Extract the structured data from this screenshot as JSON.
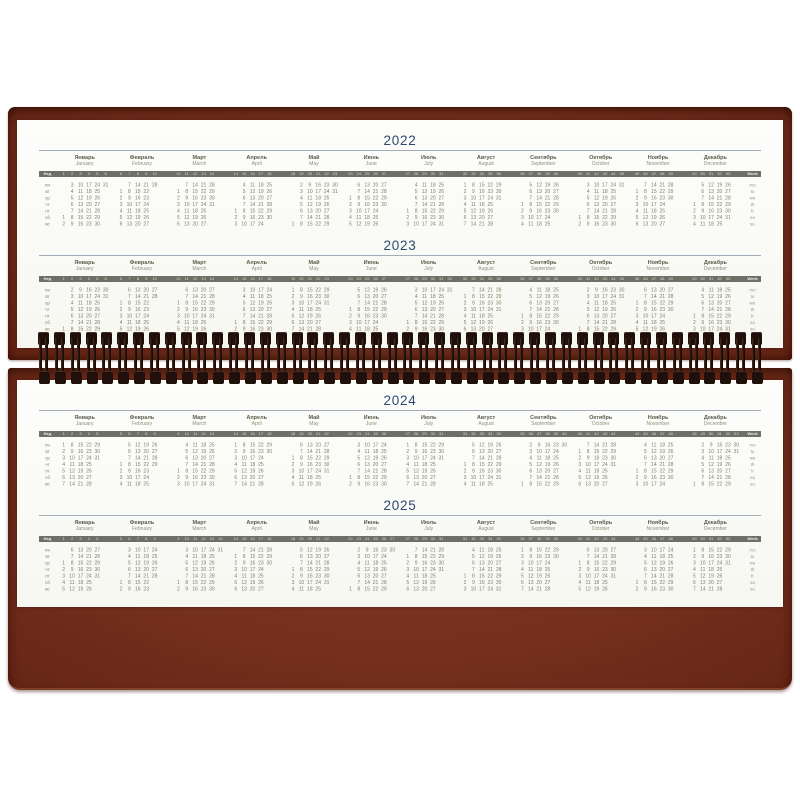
{
  "calendar": {
    "week_label_ru": "Нед",
    "week_label_en": "Week",
    "weekday_ru": [
      "пн",
      "вт",
      "ср",
      "чт",
      "пт",
      "сб",
      "вс"
    ],
    "weekday_en": [
      "mo",
      "tu",
      "we",
      "th",
      "fr",
      "sa",
      "su"
    ],
    "month_names": [
      {
        "ru": "Январь",
        "en": "January"
      },
      {
        "ru": "Февраль",
        "en": "February"
      },
      {
        "ru": "Март",
        "en": "March"
      },
      {
        "ru": "Апрель",
        "en": "April"
      },
      {
        "ru": "Май",
        "en": "May"
      },
      {
        "ru": "Июнь",
        "en": "June"
      },
      {
        "ru": "Июль",
        "en": "July"
      },
      {
        "ru": "Август",
        "en": "August"
      },
      {
        "ru": "Сентябрь",
        "en": "September"
      },
      {
        "ru": "Октябрь",
        "en": "October"
      },
      {
        "ru": "Ноябрь",
        "en": "November"
      },
      {
        "ru": "Декабрь",
        "en": "December"
      }
    ],
    "pages": [
      {
        "years": [
          {
            "label": "2022",
            "first_day_mon0": [
              5,
              1,
              1,
              4,
              6,
              2,
              4,
              0,
              3,
              5,
              1,
              3
            ],
            "month_days": [
              31,
              28,
              31,
              30,
              31,
              30,
              31,
              31,
              30,
              31,
              30,
              31
            ]
          },
          {
            "label": "2023",
            "first_day_mon0": [
              6,
              2,
              2,
              5,
              0,
              3,
              5,
              1,
              4,
              6,
              2,
              4
            ],
            "month_days": [
              31,
              28,
              31,
              30,
              31,
              30,
              31,
              31,
              30,
              31,
              30,
              31
            ]
          }
        ]
      },
      {
        "years": [
          {
            "label": "2024",
            "first_day_mon0": [
              0,
              3,
              4,
              0,
              2,
              5,
              0,
              3,
              6,
              1,
              4,
              6
            ],
            "month_days": [
              31,
              29,
              31,
              30,
              31,
              30,
              31,
              31,
              30,
              31,
              30,
              31
            ]
          },
          {
            "label": "2025",
            "first_day_mon0": [
              2,
              5,
              5,
              1,
              3,
              6,
              1,
              4,
              0,
              2,
              5,
              0
            ],
            "month_days": [
              31,
              28,
              31,
              30,
              31,
              30,
              31,
              31,
              30,
              31,
              30,
              31
            ]
          }
        ]
      }
    ],
    "colors": {
      "base_brown": "#76301e",
      "year_blue": "#2b4a6e",
      "year_underline": "#a2aeb9",
      "week_bar_gray": "#6f6f68",
      "day_number": "#80806a",
      "month_name_ru": "#5c5c4a",
      "month_name_en": "#90907d",
      "spiral_wire": "#1f100b",
      "page_white": "#fdfdfb"
    },
    "spiral_coil_count": 46
  }
}
